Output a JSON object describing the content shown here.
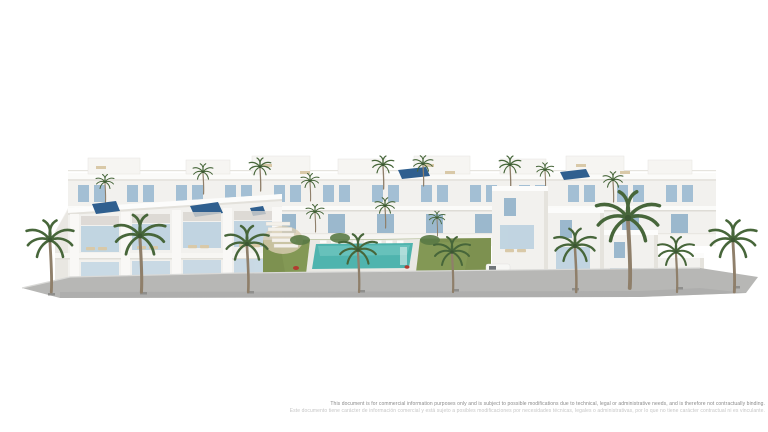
{
  "page": {
    "background_color": "#ffffff"
  },
  "rendering": {
    "alt": "Aerial 3D architectural rendering of a modern white residential complex: two facing rows of terraced townhouses with rooftop solariums and solar panels around a central landscaped courtyard with lawn, tropical plants and a communal swimming pool lined with sun loungers; palm trees stand along the grey front sidewalk.",
    "colors": {
      "building_white": "#f2f1ee",
      "building_shadow": "#e5e3dd",
      "roof_white": "#fbfbf9",
      "window_blue": "#a3bfd4",
      "door_blue": "#9bb8cd",
      "glass_blue": "#bdd2e0",
      "glass_blue_light": "#c6d8e4",
      "solar_panel_blue": "#2f5f8f",
      "lawn_green": "#7d9150",
      "plant_green": "#3f5c33",
      "plant_green_light": "#567743",
      "palm_frond_green": "#47663a",
      "palm_trunk_brown": "#8f7f6a",
      "pool_teal": "#4fb4ae",
      "pool_deck_white": "#e9e8e3",
      "sidewalk_grey": "#b7b7b5",
      "curb_light_grey": "#d9d9d7",
      "lounger_beige": "#d9c9a8",
      "lounger_white": "#fcfcfa",
      "parasol_red": "#b23b30",
      "sand_beige": "#d9cdb2"
    }
  },
  "disclaimer": {
    "line1": "This document is for commercial information purposes only and is subject to possible modifications due to technical, legal or administrative needs, and is therefore not contractually binding.",
    "line2": "Este documento tiene carácter de información comercial y está sujeto a posibles modificaciones por necesidades técnicas, legales o administrativas, por lo que no tiene carácter contractual ni es vinculante."
  }
}
